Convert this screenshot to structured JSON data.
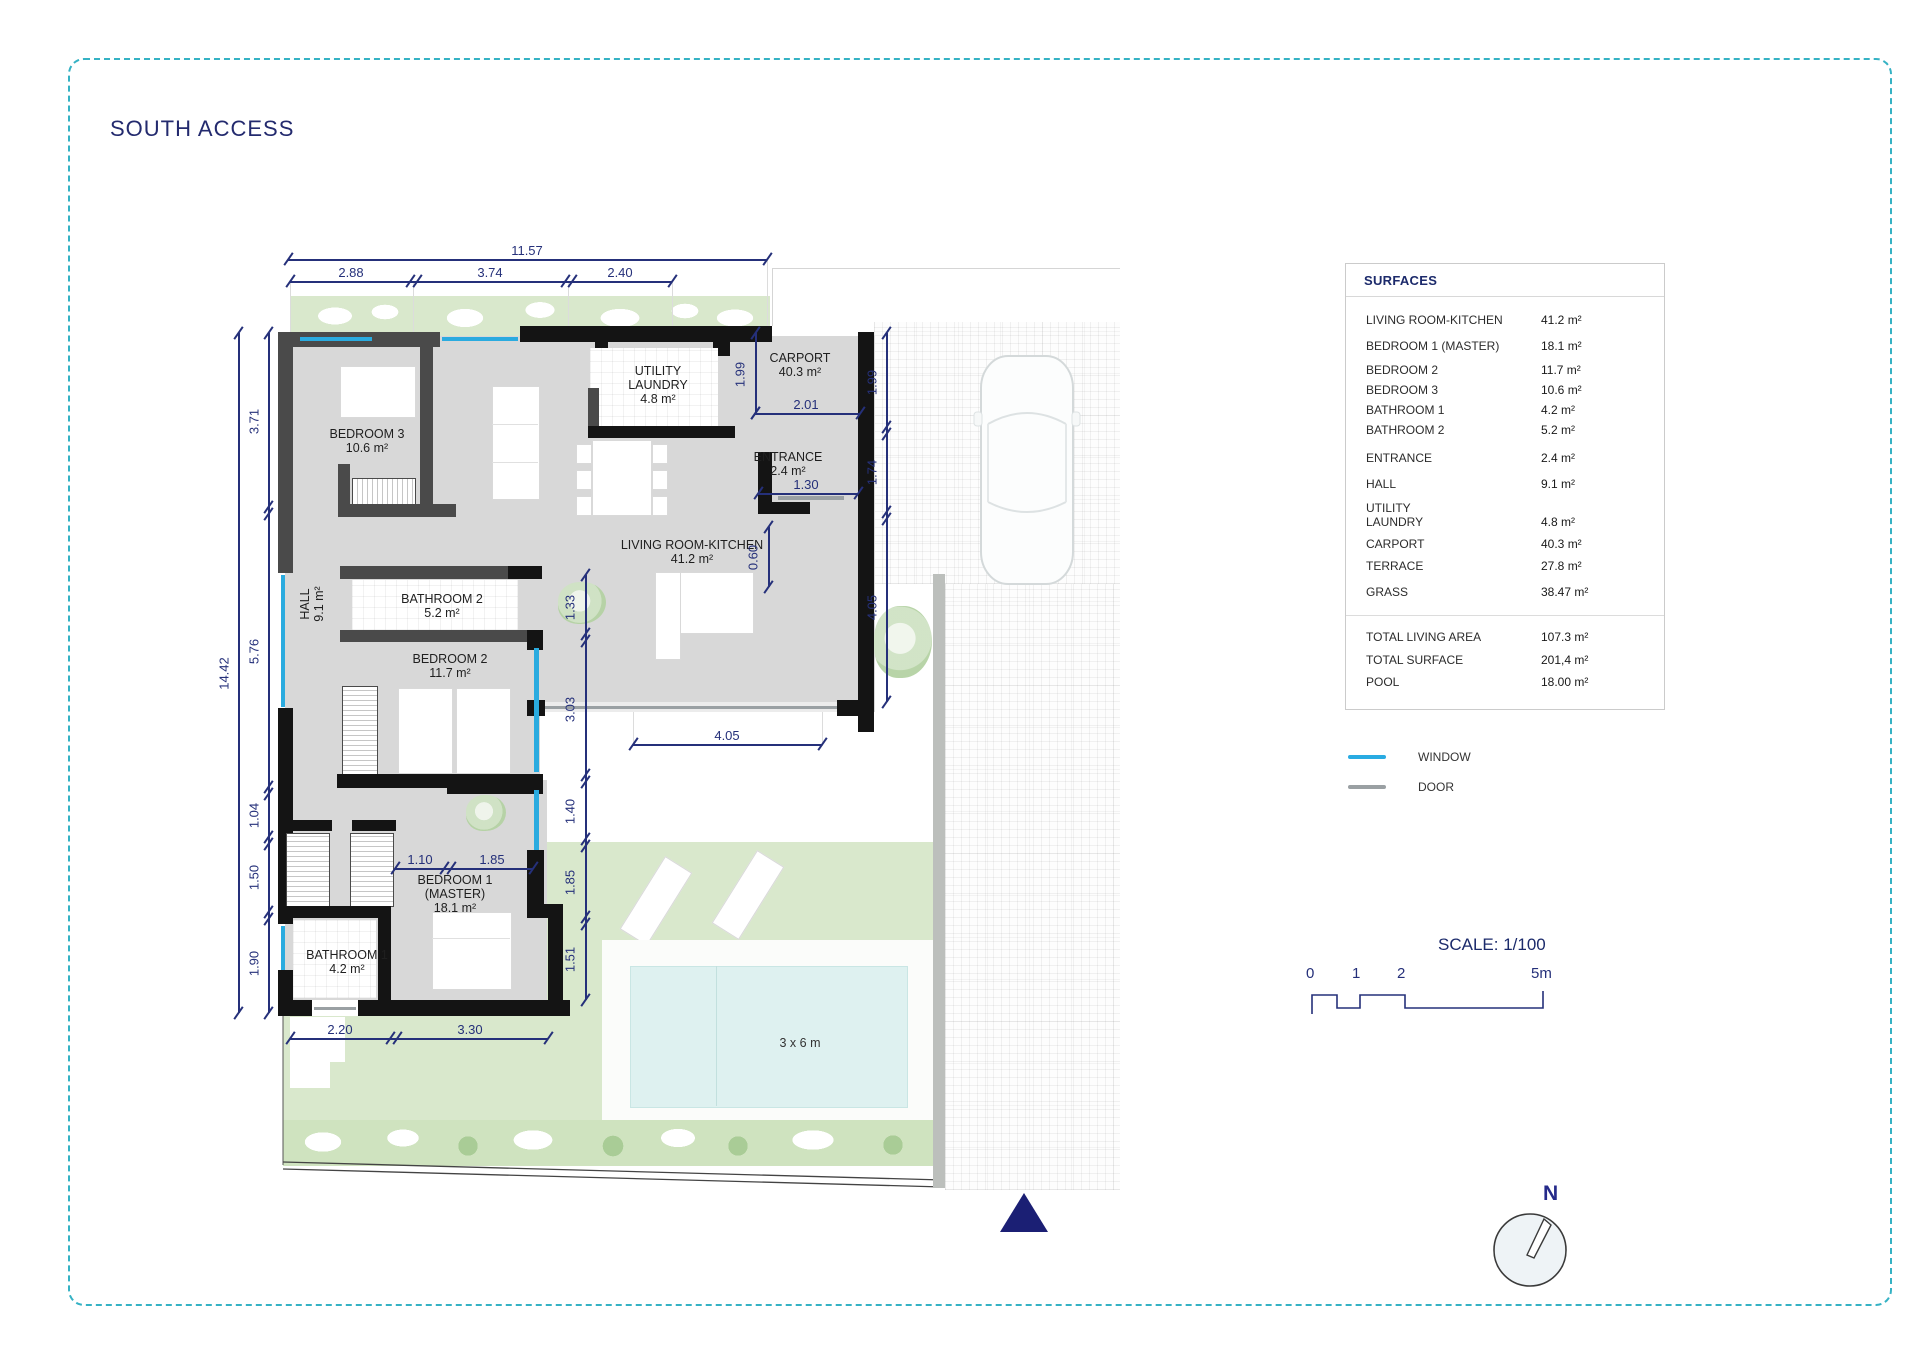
{
  "title": "SOUTH ACCESS",
  "north_label": "N",
  "surfaces": {
    "header": "SURFACES",
    "rows": [
      {
        "label": "LIVING ROOM-KITCHEN",
        "value": "41.2 m²"
      },
      {
        "label": "BEDROOM 1 (MASTER)",
        "value": "18.1 m²"
      },
      {
        "label": "BEDROOM 2",
        "value": "11.7 m²"
      },
      {
        "label": "BEDROOM 3",
        "value": "10.6 m²"
      },
      {
        "label": "BATHROOM 1",
        "value": "4.2 m²"
      },
      {
        "label": "BATHROOM 2",
        "value": "5.2 m²"
      },
      {
        "label": "ENTRANCE",
        "value": "2.4 m²"
      },
      {
        "label": "HALL",
        "value": "9.1 m²"
      },
      {
        "label": "UTILITY LAUNDRY",
        "value": "4.8 m²"
      },
      {
        "label": "CARPORT",
        "value": "40.3 m²"
      },
      {
        "label": "TERRACE",
        "value": "27.8 m²"
      },
      {
        "label": "GRASS",
        "value": "38.47 m²"
      }
    ],
    "totals": [
      {
        "label": "TOTAL LIVING AREA",
        "value": "107.3 m²"
      },
      {
        "label": "TOTAL SURFACE",
        "value": "201,4 m²"
      },
      {
        "label": "POOL",
        "value": "18.00 m²"
      }
    ]
  },
  "legend": {
    "window": "WINDOW",
    "door": "DOOR",
    "window_color": "#29abe2",
    "door_color": "#9aa0a3"
  },
  "scale": {
    "label": "SCALE: 1/100",
    "ticks": [
      "0",
      "1",
      "2",
      "5m"
    ]
  },
  "plan": {
    "pool_label": "3 x 6 m",
    "rooms": {
      "bedroom3": {
        "name": "BEDROOM 3",
        "area": "10.6 m²"
      },
      "utility": {
        "name": "UTILITY",
        "name2": "LAUNDRY",
        "area": "4.8 m²"
      },
      "carport": {
        "name": "CARPORT",
        "area": "40.3 m²"
      },
      "entrance": {
        "name": "ENTRANCE",
        "area": "2.4 m²"
      },
      "living": {
        "name": "LIVING ROOM-KITCHEN",
        "area": "41.2 m²"
      },
      "hall": {
        "name": "HALL",
        "area": "9.1 m²"
      },
      "bathroom2": {
        "name": "BATHROOM 2",
        "area": "5.2 m²"
      },
      "bedroom2": {
        "name": "BEDROOM 2",
        "area": "11.7 m²"
      },
      "master": {
        "name": "BEDROOM 1",
        "name2": "(MASTER)",
        "area": "18.1 m²"
      },
      "bathroom1": {
        "name": "BATHROOM 1",
        "area": "4.2 m²"
      }
    },
    "dims": {
      "top_total": "11.57",
      "top_1": "2.88",
      "top_2": "3.74",
      "top_3": "2.40",
      "left_total": "14.42",
      "left_1": "3.71",
      "left_2": "5.76",
      "left_3": "1.04",
      "left_4": "1.50",
      "left_5": "1.90",
      "carport_depth": "1.99",
      "carport_width": "2.01",
      "right_1": "1.99",
      "right_2": "1.74",
      "right_3": "4.05",
      "entrance_door": "1.30",
      "wall_nib": "0.60",
      "east_1": "1.33",
      "east_2": "3.03",
      "east_3": "1.40",
      "east_4": "1.85",
      "east_5": "1.51",
      "master_1": "1.10",
      "master_2": "1.85",
      "bottom_1": "2.20",
      "bottom_2": "3.30",
      "terrace_width": "4.05"
    }
  }
}
